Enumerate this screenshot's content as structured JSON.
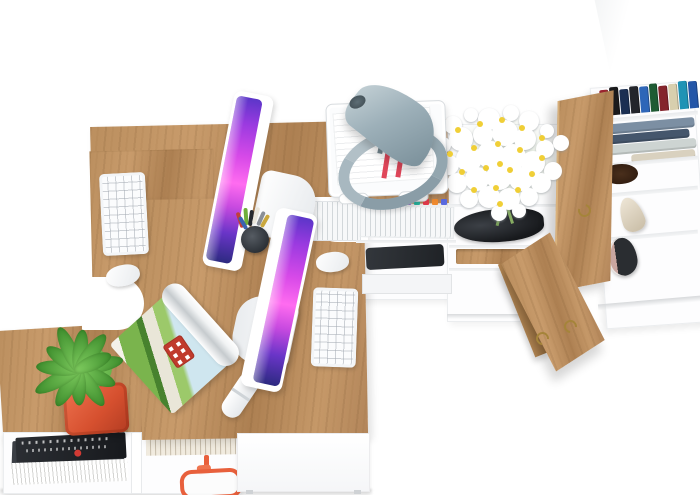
{
  "scene": {
    "title": "Top-down 3D render of a white and oak office furniture set: two computer workstations, storage cabinets and an open wardrobe",
    "background": "#ffffff"
  },
  "palette": {
    "oak_wood": "#c0925f",
    "oak_wood_dark": "#a87e4e",
    "white_furniture": "#ffffff",
    "furniture_edge_gray": "#e9ecee",
    "lamp_gray_blue": "#9fb2bb",
    "screen_purple": "#7b2fd6",
    "screen_magenta": "#ff6cf0",
    "screen_deep_blue": "#2c2a80",
    "plant_green": "#5cb849",
    "pot_orange_red": "#d6502f",
    "daisy_petal": "#ffffff",
    "daisy_center": "#f0cd2d",
    "paper_stripe_red": "#e0475a",
    "glasses_orange": "#e8603c",
    "brass_handle": "#a5843a",
    "laptop_dark": "#2c2f33",
    "shoe_dark": "#2b2e33",
    "heel_beige": "#e2d8c6"
  },
  "desk_items": [
    "imac monitor x2",
    "white keyboard x2",
    "white mouse x2",
    "gray desk lamp",
    "pencil cup",
    "wire document tray with papers",
    "rolled magazine",
    "potted succulent"
  ],
  "pens": [
    "#c04038",
    "#6fae3a",
    "#26292e",
    "#e9e5da",
    "#8a8f96",
    "#caa83e",
    "#3a62b0"
  ],
  "files_cabinet": {
    "tabs": [
      "#e85a9b",
      "#f2c73a",
      "#6fbf4a",
      "#3a8fe0",
      "#e0603a",
      "#9b59d0",
      "#2ab6a0",
      "#e23a4a",
      "#f08a2e",
      "#5a6ae0"
    ]
  },
  "wardrobe": {
    "books": [
      "#9b2430",
      "#1a1a1c",
      "#1b2f52",
      "#23252b",
      "#2e66b8",
      "#1e5b33",
      "#84242c",
      "#d8cfae",
      "#1f93b5",
      "#2456a8"
    ],
    "clothes": [
      "#7c8fa3",
      "#45566c",
      "#cdd4d2",
      "#97a3b0",
      "#d9d1bf"
    ],
    "items": [
      "books",
      "folded clothes",
      "plush toy",
      "high heel shoe",
      "sneakers"
    ]
  }
}
